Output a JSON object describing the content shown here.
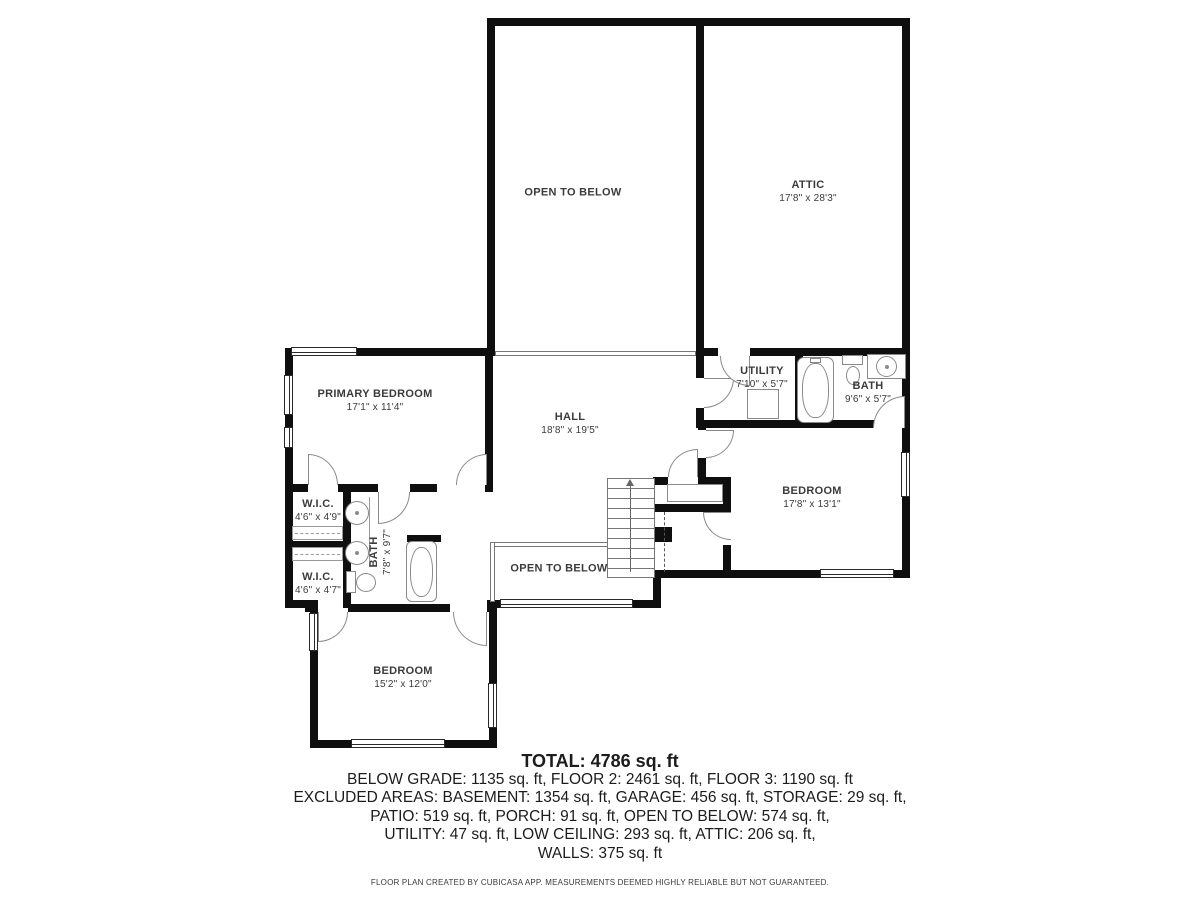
{
  "plan": {
    "labels": {
      "open_to_below_upper": "OPEN TO BELOW",
      "open_to_below_lower": "OPEN TO BELOW",
      "attic": {
        "name": "ATTIC",
        "dims": "17'8\" x 28'3\""
      },
      "primary_bedroom": {
        "name": "PRIMARY BEDROOM",
        "dims": "17'1\" x 11'4\""
      },
      "hall": {
        "name": "HALL",
        "dims": "18'8\" x 19'5\""
      },
      "utility": {
        "name": "UTILITY",
        "dims": "7'10\" x 5'7\""
      },
      "bath_upper": {
        "name": "BATH",
        "dims": "9'6\" x 5'7\""
      },
      "bedroom_right": {
        "name": "BEDROOM",
        "dims": "17'8\" x 13'1\""
      },
      "wic_upper": {
        "name": "W.I.C.",
        "dims": "4'6\" x 4'9\""
      },
      "bath_left": {
        "name": "BATH",
        "dims": "7'8\" x 9'7\""
      },
      "wic_lower": {
        "name": "W.I.C.",
        "dims": "4'6\" x 4'7\""
      },
      "bedroom_bottom": {
        "name": "BEDROOM",
        "dims": "15'2\" x 12'0\""
      }
    },
    "summary": {
      "total": "TOTAL: 4786 sq. ft",
      "lines": [
        "BELOW GRADE: 1135 sq. ft, FLOOR 2: 2461 sq. ft, FLOOR 3: 1190 sq. ft",
        "EXCLUDED AREAS: BASEMENT: 1354 sq. ft, GARAGE: 456 sq. ft, STORAGE: 29 sq. ft,",
        "PATIO: 519 sq. ft, PORCH: 91 sq. ft, OPEN TO BELOW: 574 sq. ft,",
        "UTILITY: 47 sq. ft, LOW CEILING: 293 sq. ft, ATTIC: 206 sq. ft,",
        "WALLS: 375 sq. ft"
      ]
    },
    "footer": "FLOOR PLAN CREATED BY CUBICASA APP. MEASUREMENTS DEEMED HIGHLY RELIABLE BUT NOT GUARANTEED.",
    "colors": {
      "wall": "#0f0f0f",
      "fixture": "#8a8a8a",
      "text": "#1c1c1c",
      "label": "#3b3b3b"
    }
  }
}
